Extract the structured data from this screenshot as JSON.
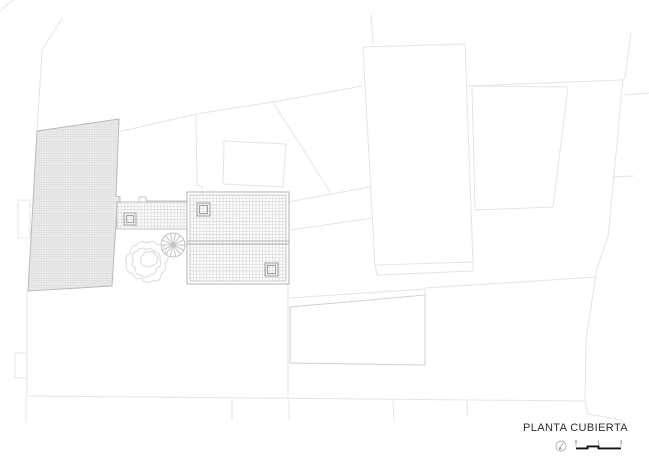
{
  "title_block": {
    "title": "PLANTA CUBIERTA",
    "scale": {
      "labels": [
        "0",
        "1",
        "2"
      ]
    }
  },
  "colors": {
    "parcel_line": "#e4e4e4",
    "building_line": "#cfcfcf",
    "roof_border": "#b2b2b2",
    "grid_line": "#d9d9d9",
    "hatch_fill": "#efefef",
    "scale_bar": "#151515",
    "title_text": "#2d2d2d"
  },
  "drawing": {
    "layers": [
      {
        "name": "parcel-lines",
        "stroke": "#e4e4e4",
        "width": 1,
        "items": [
          {
            "t": "pl",
            "p": [
              [
                13,
                0
              ],
              [
                0,
                11
              ]
            ]
          },
          {
            "t": "pl",
            "p": [
              [
                63,
                17
              ],
              [
                42,
                50
              ],
              [
                37,
                131
              ]
            ]
          },
          {
            "t": "pl",
            "p": [
              [
                371,
                14
              ],
              [
                373,
                45
              ]
            ]
          },
          {
            "t": "pg",
            "p": [
              [
                363,
                47
              ],
              [
                465,
                44
              ],
              [
                473,
                262
              ],
              [
                375,
                265
              ]
            ]
          },
          {
            "t": "pl",
            "p": [
              [
                375,
                265
              ],
              [
                377,
                275
              ],
              [
                473,
                271
              ],
              [
                473,
                262
              ]
            ]
          },
          {
            "t": "pg",
            "p": [
              [
                472,
                86
              ],
              [
                568,
                87
              ],
              [
                553,
                207
              ],
              [
                475,
                210
              ]
            ]
          },
          {
            "t": "pl",
            "p": [
              [
                467,
                86
              ],
              [
                623,
                80
              ]
            ]
          },
          {
            "t": "pl",
            "p": [
              [
                631,
                33
              ],
              [
                625,
                77
              ],
              [
                623,
                80
              ],
              [
                608,
                237
              ],
              [
                597,
                268
              ],
              [
                586,
                340
              ],
              [
                585,
                400
              ],
              [
                588,
                414
              ],
              [
                622,
                420
              ]
            ]
          },
          {
            "t": "pl",
            "p": [
              [
                625,
                95
              ],
              [
                649,
                93
              ]
            ]
          },
          {
            "t": "pl",
            "p": [
              [
                612,
                177
              ],
              [
                634,
                176
              ]
            ]
          },
          {
            "t": "pl",
            "p": [
              [
                118,
                132
              ],
              [
                196,
                114
              ],
              [
                273,
                102
              ],
              [
                363,
                86
              ]
            ]
          },
          {
            "t": "pl",
            "p": [
              [
                196,
                114
              ],
              [
                197,
                185
              ],
              [
                202,
                187
              ],
              [
                202,
                212
              ]
            ]
          },
          {
            "t": "pg",
            "p": [
              [
                224,
                141
              ],
              [
                286,
                144
              ],
              [
                283,
                187
              ],
              [
                223,
                184
              ]
            ]
          },
          {
            "t": "pl",
            "p": [
              [
                273,
                102
              ],
              [
                330,
                192
              ]
            ]
          },
          {
            "t": "pl",
            "p": [
              [
                288,
                202
              ],
              [
                370,
                187
              ]
            ]
          },
          {
            "t": "pl",
            "p": [
              [
                290,
                230
              ],
              [
                373,
                218
              ]
            ]
          },
          {
            "t": "pl",
            "p": [
              [
                289,
                298
              ],
              [
                425,
                289
              ],
              [
                425,
                295
              ]
            ]
          },
          {
            "t": "pl",
            "p": [
              [
                425,
                288
              ],
              [
                597,
                277
              ]
            ]
          },
          {
            "t": "pl",
            "p": [
              [
                28,
                396
              ],
              [
                585,
                401
              ]
            ]
          },
          {
            "t": "pl",
            "p": [
              [
                26,
                396
              ],
              [
                26,
                422
              ]
            ]
          },
          {
            "t": "pl",
            "p": [
              [
                232,
                400
              ],
              [
                232,
                420
              ]
            ]
          },
          {
            "t": "pl",
            "p": [
              [
                289,
                401
              ],
              [
                289,
                420
              ]
            ]
          },
          {
            "t": "pl",
            "p": [
              [
                393,
                401
              ],
              [
                394,
                421
              ]
            ]
          },
          {
            "t": "pl",
            "p": [
              [
                467,
                401
              ],
              [
                468,
                417
              ]
            ]
          },
          {
            "t": "rc",
            "x": 18,
            "y": 200,
            "w": 12,
            "h": 38
          },
          {
            "t": "rc",
            "x": 15,
            "y": 353,
            "w": 12,
            "h": 25
          },
          {
            "t": "pl",
            "p": [
              [
                27,
                291
              ],
              [
                27,
                396
              ]
            ]
          },
          {
            "t": "pl",
            "p": [
              [
                288,
                284
              ],
              [
                288,
                399
              ]
            ]
          }
        ]
      },
      {
        "name": "neighbor-building",
        "stroke": "#cfcfcf",
        "width": 1,
        "items": [
          {
            "t": "pg",
            "p": [
              [
                290,
                307
              ],
              [
                425,
                295
              ],
              [
                425,
                365
              ],
              [
                290,
                363
              ]
            ],
            "fill": "#ffffff"
          }
        ]
      },
      {
        "name": "hatched-roof",
        "stroke": "#b9b9b9",
        "width": 1,
        "items": [
          {
            "t": "grid",
            "clip": [
              [
                37,
                131
              ],
              [
                119,
                119
              ],
              [
                116,
                196
              ],
              [
                120,
                197
              ],
              [
                120,
                206
              ],
              [
                117,
                207
              ],
              [
                112,
                286
              ],
              [
                28,
                291
              ]
            ],
            "x0": 20,
            "y0": 115,
            "x1": 125,
            "y1": 295,
            "s": 2.4,
            "bg": "#efefef",
            "stroke": "#dcdcdc"
          },
          {
            "t": "pg",
            "p": [
              [
                37,
                131
              ],
              [
                119,
                119
              ],
              [
                116,
                196
              ],
              [
                120,
                197
              ],
              [
                120,
                206
              ],
              [
                117,
                207
              ],
              [
                112,
                286
              ],
              [
                28,
                291
              ]
            ]
          }
        ]
      },
      {
        "name": "courtyard-edges",
        "stroke": "#c6c6c6",
        "width": 1,
        "items": [
          {
            "t": "pl",
            "p": [
              [
                117,
                202
              ],
              [
                139,
                202
              ],
              [
                139,
                197
              ],
              [
                146,
                197
              ],
              [
                146,
                201
              ],
              [
                187,
                201
              ]
            ]
          },
          {
            "t": "pl",
            "p": [
              [
                117,
                229
              ],
              [
                187,
                229
              ]
            ]
          }
        ]
      },
      {
        "name": "terrace-grid",
        "stroke": "#bdbdbd",
        "width": 1,
        "items": [
          {
            "t": "grid",
            "clip": [
              [
                118,
                203
              ],
              [
                186,
                203
              ],
              [
                186,
                228
              ],
              [
                118,
                228
              ]
            ],
            "x0": 118,
            "y0": 203,
            "x1": 186,
            "y1": 228,
            "s": 3.3,
            "bg": "#fcfcfc",
            "stroke": "#d9d9d9"
          },
          {
            "t": "rc",
            "x": 117,
            "y": 202,
            "w": 70,
            "h": 27
          },
          {
            "t": "sq2",
            "x": 124,
            "y": 213,
            "s": 12,
            "i": 2.5,
            "stroke": "#a5a5a5"
          }
        ]
      },
      {
        "name": "main-roof",
        "stroke": "#b2b2b2",
        "width": 1,
        "items": [
          {
            "t": "grid",
            "clip": [
              [
                190,
                195
              ],
              [
                286,
                195
              ],
              [
                286,
                281
              ],
              [
                190,
                281
              ]
            ],
            "x0": 190,
            "y0": 195,
            "x1": 286,
            "y1": 281,
            "s": 3.3,
            "bg": "#fdfdfd",
            "stroke": "#d9d9d9"
          },
          {
            "t": "rc",
            "x": 187,
            "y": 192,
            "w": 102,
            "h": 92
          },
          {
            "t": "rc",
            "x": 190,
            "y": 195,
            "w": 96,
            "h": 86,
            "stroke": "#c9c9c9"
          },
          {
            "t": "ln",
            "p": [
              187,
              241,
              289,
              241
            ]
          },
          {
            "t": "ln",
            "p": [
              187,
              244,
              289,
              244
            ]
          },
          {
            "t": "sq2",
            "x": 197,
            "y": 203,
            "s": 13,
            "i": 2.5,
            "stroke": "#9e9e9e"
          },
          {
            "t": "sq2",
            "x": 265,
            "y": 263,
            "s": 13,
            "i": 2.5,
            "stroke": "#9e9e9e"
          }
        ]
      },
      {
        "name": "spiral-stair",
        "stroke": "#c2c2c2",
        "width": 1,
        "items": [
          {
            "t": "wheel",
            "cx": 173,
            "cy": 245,
            "r": 12,
            "n": 14
          }
        ]
      },
      {
        "name": "tree",
        "stroke": "#dadada",
        "width": 1,
        "items": [
          {
            "t": "cloud",
            "cx": 147,
            "cy": 261,
            "r": 19,
            "n": 11,
            "rx": 6.5
          },
          {
            "t": "cloud",
            "cx": 146,
            "cy": 262,
            "r": 13,
            "n": 9,
            "rx": 5.4
          },
          {
            "t": "cloud",
            "cx": 149,
            "cy": 259,
            "r": 7.5,
            "n": 7,
            "rx": 4.2
          }
        ]
      }
    ]
  }
}
